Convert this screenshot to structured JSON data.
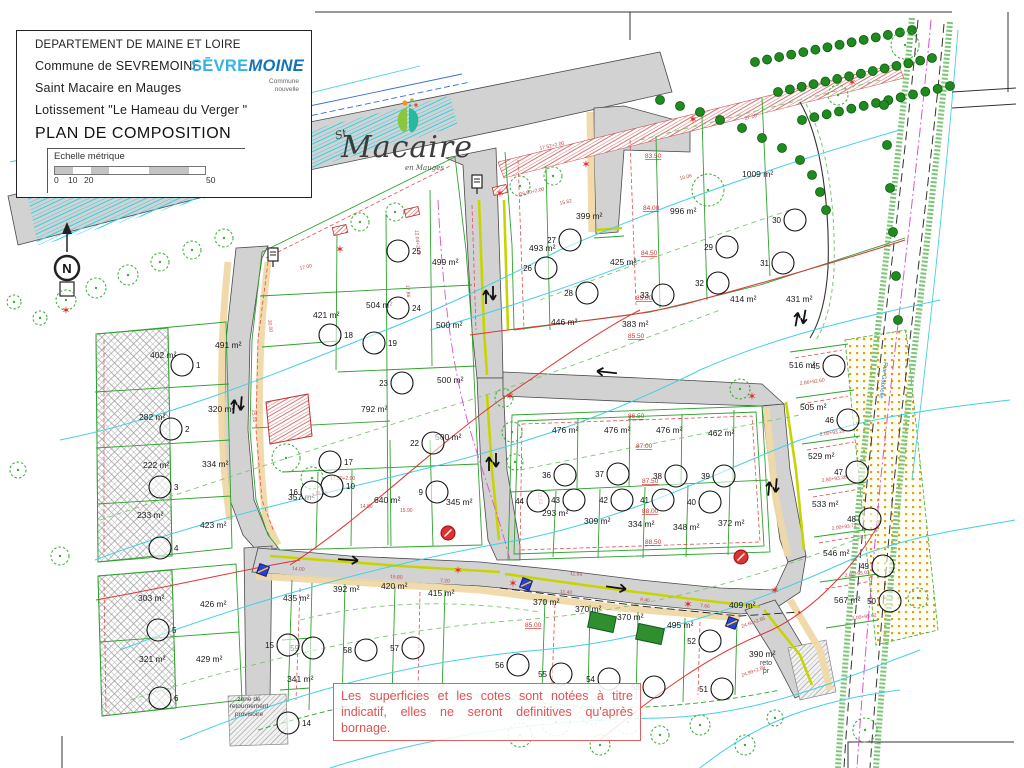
{
  "title_block": {
    "line1": "DEPARTEMENT DE MAINE ET LOIRE",
    "line2": "Commune de SEVREMOINE",
    "line3": "Saint Macaire en Mauges",
    "line4": "Lotissement \"Le Hameau du Verger \"",
    "title": "PLAN DE COMPOSITION",
    "scale_label": "Echelle métrique",
    "tick0": "0",
    "tick10": "10",
    "tick20": "20",
    "tick50": "50"
  },
  "logos": {
    "sevremoine": {
      "part1": "SĒVRE",
      "part2": "MOINE",
      "color1": "#36b3e5",
      "color2": "#1272ba",
      "sub1": "Commune",
      "sub2": "nouvelle"
    },
    "macaire": {
      "sup": "St",
      "script": "Macaire",
      "sub": "en Mauges"
    }
  },
  "note": {
    "text": "Les superficies et les cotes sont notées à titre indicatif, elles ne seront definitives qu'après bornage."
  },
  "north": {
    "label": "N"
  },
  "map": {
    "road_name": "Rue Gabrielle",
    "turnaround_left": "zone de\nretournement\nprovisoire",
    "turnaround_right": "reto\npr",
    "colors": {
      "road": "#d2d2d2",
      "parcel_green": "#2ea12e",
      "red_dash": "#e05050",
      "contour_cyan": "#45cfe2",
      "yellow_edge": "#c8d400",
      "tan_band": "#f0d9a8",
      "magenta": "#e14fd2",
      "hedge": "#1f8a1f"
    },
    "area_labels": [
      [
        "402 m²",
        150,
        358
      ],
      [
        "282 m²",
        139,
        420
      ],
      [
        "222 m²",
        143,
        468
      ],
      [
        "233 m²",
        137,
        518
      ],
      [
        "303 m²",
        138,
        601
      ],
      [
        "321 m²",
        139,
        662
      ],
      [
        "491 m²",
        215,
        348
      ],
      [
        "320 m²",
        208,
        412
      ],
      [
        "334 m²",
        202,
        467
      ],
      [
        "423 m²",
        200,
        528
      ],
      [
        "426 m²",
        200,
        607
      ],
      [
        "429 m²",
        196,
        662
      ],
      [
        "421 m²",
        313,
        318
      ],
      [
        "504 m²",
        366,
        308
      ],
      [
        "499 m²",
        432,
        265
      ],
      [
        "500 m²",
        436,
        328
      ],
      [
        "500 m²",
        437,
        383
      ],
      [
        "500 m²",
        435,
        440
      ],
      [
        "792 m²",
        361,
        412
      ],
      [
        "357 m²",
        288,
        500
      ],
      [
        "640 m²",
        374,
        503
      ],
      [
        "345 m²",
        446,
        505
      ],
      [
        "493 m²",
        529,
        251
      ],
      [
        "399 m²",
        576,
        219
      ],
      [
        "425 m²",
        610,
        265
      ],
      [
        "996 m²",
        670,
        214
      ],
      [
        "1009 m²",
        742,
        177
      ],
      [
        "446 m²",
        551,
        325
      ],
      [
        "383 m²",
        622,
        327
      ],
      [
        "414 m²",
        730,
        302
      ],
      [
        "431 m²",
        786,
        302
      ],
      [
        "476 m²",
        552,
        433
      ],
      [
        "476 m²",
        604,
        433
      ],
      [
        "476 m²",
        656,
        433
      ],
      [
        "462 m²",
        708,
        436
      ],
      [
        "293 m²",
        542,
        516
      ],
      [
        "309 m²",
        584,
        524
      ],
      [
        "334 m²",
        628,
        527
      ],
      [
        "348 m²",
        673,
        530
      ],
      [
        "372 m²",
        718,
        526
      ],
      [
        "516 m²",
        789,
        368
      ],
      [
        "505 m²",
        800,
        410
      ],
      [
        "529 m²",
        808,
        459
      ],
      [
        "533 m²",
        812,
        507
      ],
      [
        "546 m²",
        823,
        556
      ],
      [
        "567 m²",
        834,
        603
      ],
      [
        "435 m²",
        283,
        601
      ],
      [
        "392 m²",
        333,
        592
      ],
      [
        "420 m²",
        381,
        589
      ],
      [
        "415 m²",
        428,
        596
      ],
      [
        "341 m²",
        287,
        682
      ],
      [
        "370 m²",
        533,
        605
      ],
      [
        "370 m²",
        575,
        612
      ],
      [
        "370 m²",
        617,
        620
      ],
      [
        "495 m²",
        667,
        628
      ],
      [
        "409 m²",
        729,
        608
      ],
      [
        "390 m²",
        749,
        657
      ]
    ],
    "elev_labels": [
      [
        "83.50",
        645,
        158
      ],
      [
        "84.00",
        643,
        210
      ],
      [
        "84.50",
        641,
        255
      ],
      [
        "85.00",
        636,
        300
      ],
      [
        "85.50",
        628,
        338
      ],
      [
        "86.50",
        628,
        418
      ],
      [
        "87.00",
        636,
        448
      ],
      [
        "87.50",
        642,
        483
      ],
      [
        "88.00",
        642,
        513
      ],
      [
        "88.50",
        645,
        544
      ],
      [
        "85.00",
        525,
        627
      ]
    ],
    "lots": [
      [
        "1",
        182,
        365,
        "r"
      ],
      [
        "2",
        171,
        429,
        "r"
      ],
      [
        "3",
        160,
        487,
        "r"
      ],
      [
        "4",
        160,
        548,
        "r"
      ],
      [
        "5",
        158,
        630,
        "r"
      ],
      [
        "6",
        160,
        698,
        "r"
      ],
      [
        "9",
        437,
        492,
        "l"
      ],
      [
        "10",
        332,
        486,
        "r"
      ],
      [
        "16",
        312,
        492,
        "l"
      ],
      [
        "17",
        330,
        462,
        "r"
      ],
      [
        "18",
        330,
        335,
        "r"
      ],
      [
        "19",
        374,
        343,
        "r"
      ],
      [
        "22",
        433,
        443,
        "l"
      ],
      [
        "23",
        402,
        383,
        "l"
      ],
      [
        "24",
        398,
        308,
        "r"
      ],
      [
        "25",
        398,
        251,
        "r"
      ],
      [
        "26",
        546,
        268,
        "l"
      ],
      [
        "27",
        570,
        240,
        "l"
      ],
      [
        "28",
        587,
        293,
        "l"
      ],
      [
        "29",
        727,
        247,
        "l"
      ],
      [
        "30",
        795,
        220,
        "l"
      ],
      [
        "31",
        783,
        263,
        "l"
      ],
      [
        "32",
        718,
        283,
        "l"
      ],
      [
        "33",
        663,
        295,
        "l"
      ],
      [
        "36",
        565,
        475,
        "l"
      ],
      [
        "37",
        618,
        474,
        "l"
      ],
      [
        "38",
        676,
        476,
        "l"
      ],
      [
        "39",
        724,
        476,
        "l"
      ],
      [
        "40",
        710,
        502,
        "l"
      ],
      [
        "41",
        663,
        500,
        "l"
      ],
      [
        "42",
        622,
        500,
        "l"
      ],
      [
        "43",
        574,
        500,
        "l"
      ],
      [
        "44",
        538,
        501,
        "l"
      ],
      [
        "45",
        834,
        366,
        "l"
      ],
      [
        "46",
        848,
        420,
        "l"
      ],
      [
        "47",
        857,
        472,
        "l"
      ],
      [
        "48",
        870,
        519,
        "l"
      ],
      [
        "49",
        883,
        566,
        "l"
      ],
      [
        "50",
        890,
        601,
        "l"
      ],
      [
        "51",
        722,
        689,
        "l"
      ],
      [
        "52",
        710,
        641,
        "l"
      ],
      [
        "53",
        654,
        687,
        "l"
      ],
      [
        "54",
        609,
        679,
        "l"
      ],
      [
        "55",
        561,
        674,
        "l"
      ],
      [
        "56",
        518,
        665,
        "l"
      ],
      [
        "57",
        413,
        648,
        "l"
      ],
      [
        "58",
        366,
        650,
        "l"
      ],
      [
        "59",
        313,
        648,
        "l"
      ],
      [
        "14",
        288,
        723,
        "r"
      ],
      [
        "15",
        288,
        645,
        "l"
      ]
    ],
    "dims": [
      [
        "17.00",
        300,
        270,
        -13
      ],
      [
        "26.00+2.00",
        520,
        196,
        -13
      ],
      [
        "15.62",
        560,
        205,
        -13
      ],
      [
        "17.52+2.00",
        540,
        150,
        -13
      ],
      [
        "30.00",
        268,
        320,
        83
      ],
      [
        "25.00",
        252,
        410,
        85
      ],
      [
        "14.00",
        292,
        570,
        4
      ],
      [
        "15.80",
        390,
        578,
        4
      ],
      [
        "7.20",
        440,
        582,
        4
      ],
      [
        "11.40",
        560,
        593,
        5
      ],
      [
        "9.40",
        640,
        601,
        6
      ],
      [
        "7.66",
        700,
        607,
        6
      ],
      [
        "2.86+92.60",
        800,
        385,
        -8
      ],
      [
        "2.00+93.29",
        820,
        436,
        -8
      ],
      [
        "2.80+93.38",
        822,
        482,
        -8
      ],
      [
        "2.00+93.72",
        832,
        530,
        -8
      ],
      [
        "2.00+95.03",
        845,
        577,
        -8
      ],
      [
        "2.00+95.62",
        852,
        620,
        -8
      ],
      [
        "24.60+2.85",
        742,
        628,
        -20
      ],
      [
        "24.99+2.88",
        742,
        677,
        -20
      ],
      [
        "17.00+2.00",
        330,
        480,
        0
      ],
      [
        "16.30",
        315,
        495,
        0
      ],
      [
        "14.80",
        360,
        508,
        0
      ],
      [
        "15.90",
        400,
        512,
        0
      ],
      [
        "11.64",
        570,
        575,
        5
      ],
      [
        "12.02",
        538,
        492,
        85
      ],
      [
        "17.86",
        406,
        285,
        85
      ],
      [
        "12.04+2.19",
        415,
        230,
        85
      ],
      [
        "10.06",
        680,
        180,
        -14
      ],
      [
        "27.20",
        745,
        120,
        -14
      ]
    ],
    "trees": [
      [
        66,
        300,
        10
      ],
      [
        96,
        288,
        10
      ],
      [
        128,
        275,
        10
      ],
      [
        160,
        262,
        9
      ],
      [
        192,
        250,
        9
      ],
      [
        224,
        238,
        9
      ],
      [
        40,
        318,
        7
      ],
      [
        18,
        470,
        8
      ],
      [
        14,
        302,
        7
      ],
      [
        60,
        556,
        9
      ],
      [
        360,
        222,
        9
      ],
      [
        395,
        212,
        9
      ],
      [
        520,
        186,
        10
      ],
      [
        553,
        176,
        9
      ],
      [
        286,
        458,
        14
      ],
      [
        312,
        478,
        11
      ],
      [
        504,
        398,
        9
      ],
      [
        512,
        432,
        10
      ],
      [
        515,
        462,
        8
      ],
      [
        740,
        389,
        10
      ],
      [
        708,
        190,
        16
      ],
      [
        838,
        95,
        10
      ],
      [
        905,
        45,
        14
      ],
      [
        520,
        735,
        12
      ],
      [
        556,
        722,
        14
      ],
      [
        592,
        712,
        12
      ],
      [
        628,
        722,
        12
      ],
      [
        600,
        745,
        10
      ],
      [
        660,
        735,
        9
      ],
      [
        700,
        725,
        10
      ],
      [
        745,
        745,
        10
      ],
      [
        775,
        718,
        8
      ],
      [
        865,
        730,
        12
      ],
      [
        918,
        598,
        10
      ]
    ],
    "hedges": [
      {
        "x1": 755,
        "y1": 62,
        "x2": 912,
        "y2": 30,
        "n": 14
      },
      {
        "x1": 778,
        "y1": 92,
        "x2": 932,
        "y2": 58,
        "n": 14
      },
      {
        "x1": 802,
        "y1": 120,
        "x2": 950,
        "y2": 86,
        "n": 13
      },
      {
        "pts": [
          [
            660,
            100
          ],
          [
            680,
            106
          ],
          [
            700,
            112
          ],
          [
            720,
            120
          ],
          [
            742,
            128
          ],
          [
            762,
            138
          ],
          [
            782,
            148
          ],
          [
            800,
            160
          ],
          [
            812,
            175
          ],
          [
            820,
            192
          ],
          [
            826,
            210
          ]
        ]
      },
      {
        "pts": [
          [
            884,
            105
          ],
          [
            887,
            145
          ],
          [
            890,
            188
          ],
          [
            893,
            232
          ],
          [
            896,
            276
          ],
          [
            898,
            320
          ]
        ]
      }
    ],
    "stars": [
      [
        340,
        249
      ],
      [
        500,
        193
      ],
      [
        586,
        164
      ],
      [
        693,
        119
      ],
      [
        510,
        396
      ],
      [
        752,
        396
      ],
      [
        513,
        583
      ],
      [
        688,
        604
      ],
      [
        775,
        590
      ],
      [
        66,
        310
      ],
      [
        852,
        82
      ],
      [
        458,
        570
      ]
    ],
    "hydrants": [
      [
        448,
        533
      ],
      [
        741,
        557
      ]
    ],
    "blue_squares": [
      [
        263,
        570
      ],
      [
        526,
        584
      ],
      [
        732,
        623
      ]
    ],
    "signs": [
      [
        477,
        182
      ],
      [
        273,
        255
      ]
    ],
    "green_rects": [
      [
        602,
        622
      ],
      [
        650,
        634
      ]
    ],
    "red_walls": [
      [
        340,
        230
      ],
      [
        412,
        212
      ],
      [
        500,
        190
      ]
    ],
    "arrows_double": [
      [
        237,
        405,
        95
      ],
      [
        489,
        295,
        90
      ],
      [
        492,
        462,
        90
      ],
      [
        772,
        487,
        95
      ],
      [
        800,
        318,
        100
      ]
    ],
    "arrows_single": [
      [
        350,
        560,
        4
      ],
      [
        618,
        588,
        8
      ],
      [
        605,
        372,
        186
      ]
    ]
  }
}
